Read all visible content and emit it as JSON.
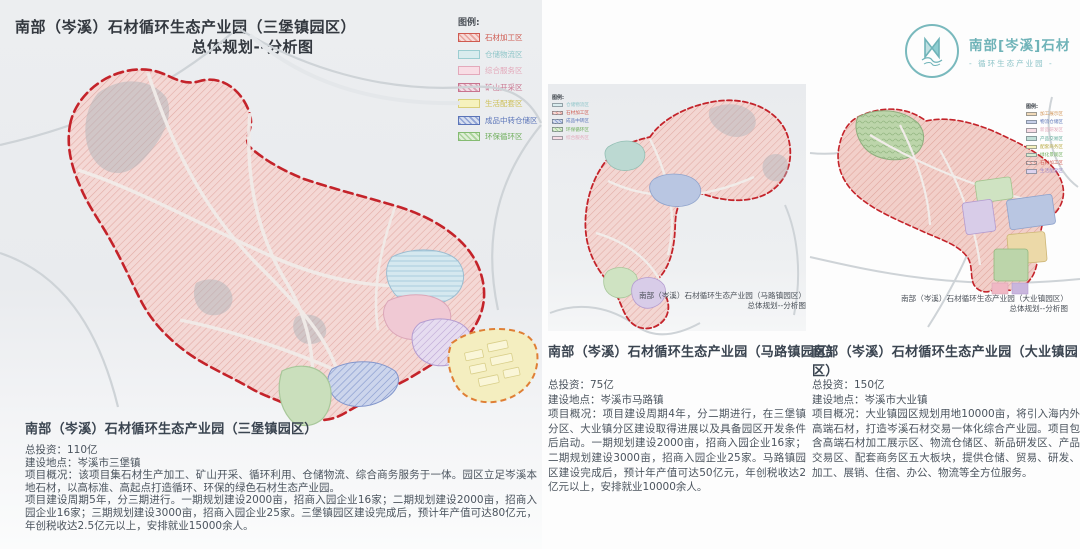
{
  "palette": {
    "boundary_red": "#c4232a",
    "boundary_orange": "#df7f35",
    "parcel_pink": "#f4d8d5",
    "map_background": "#e9ebee",
    "logo_teal": "#6fb3b8",
    "title_color": "#33383f",
    "body_color": "#4b545e"
  },
  "left_panel": {
    "title_line1": "南部（岑溪）石材循环生态产业园（三堡镇园区）",
    "title_line2": "总体规划--分析图",
    "legend": {
      "heading": "图例:",
      "items": [
        {
          "label": "石材加工区",
          "color": "#cf5a50"
        },
        {
          "label": "仓储物流区",
          "color": "#8fc6c9"
        },
        {
          "label": "综合服务区",
          "color": "#e3a9bb"
        },
        {
          "label": "矿山开采区",
          "color": "#c9738e"
        },
        {
          "label": "生活配套区",
          "color": "#cdbf55"
        },
        {
          "label": "成品中转仓储区",
          "color": "#5a74b8"
        },
        {
          "label": "环保循环区",
          "color": "#6fae5c"
        }
      ]
    },
    "section_title": "南部（岑溪）石材循环生态产业园（三堡镇园区）",
    "info_lines": [
      "总投资：110亿",
      "建设地点：岑溪市三堡镇",
      "项目概况：该项目集石材生产加工、矿山开采、循环利用、仓储物流、综合商务服务于一体。园区立足岑溪本地石材，以高标准、高起点打造循环、环保的绿色石材生态产业园。",
      "项目建设周期5年，分三期进行。一期规划建设2000亩，招商入园企业16家；二期规划建设2000亩，招商入园企业16家；三期规划建设3000亩，招商入园企业25家。三堡镇园区建设完成后，预计年产值可达80亿元，年创税收达2.5亿元以上，安排就业15000余人。"
    ]
  },
  "middle_panel": {
    "legend_heading": "图例:",
    "legend_items": [
      {
        "label": "仓储物流区",
        "color": "#8fc6c9"
      },
      {
        "label": "石材加工区",
        "color": "#cf5a50"
      },
      {
        "label": "成品中转区",
        "color": "#5a74b8"
      },
      {
        "label": "环保循环区",
        "color": "#6fae5c"
      },
      {
        "label": "综合服务区",
        "color": "#e3a9bb"
      }
    ],
    "map_caption_line1": "南部（岑溪）石材循环生态产业园（马路镇园区）",
    "map_caption_line2": "总体规划--分析图",
    "section_title": "南部（岑溪）石材循环生态产业园（马路镇园区）",
    "info_lines": [
      "总投资：75亿",
      "建设地点：岑溪市马路镇",
      "项目概况：项目建设周期4年，分二期进行，在三堡镇分区、大业镇分区建设取得进展以及具备园区开发条件后启动。一期规划建设2000亩，招商入园企业16家；二期规划建设3000亩，招商入园企业25家。马路镇园区建设完成后，预计年产值可达50亿元，年创税收达2亿元以上，安排就业10000余人。"
    ]
  },
  "right_panel": {
    "logo": {
      "name_line": "南部[岑溪]石材",
      "sub_line": "- 循环生态产业园 -"
    },
    "legend_heading": "图例:",
    "legend_items": [
      {
        "label": "加工展示区",
        "color": "#cf9353"
      },
      {
        "label": "物流仓储区",
        "color": "#5a74b8"
      },
      {
        "label": "新品研发区",
        "color": "#e3a9bb"
      },
      {
        "label": "产品交易区",
        "color": "#5aa796"
      },
      {
        "label": "配套商务区",
        "color": "#cdbf55"
      },
      {
        "label": "绿化景观区",
        "color": "#6fae5c"
      },
      {
        "label": "石材加工区",
        "color": "#cf5a50"
      },
      {
        "label": "生活配套区",
        "color": "#9a86c9"
      }
    ],
    "map_caption_line1": "南部（岑溪）石材循环生态产业园（大业镇园区）",
    "map_caption_line2": "总体规划--分析图",
    "section_title": "南部（岑溪）石材循环生态产业园（大业镇园区）",
    "info_lines": [
      "总投资：150亿",
      "建设地点：岑溪市大业镇",
      "项目概况：大业镇园区规划用地10000亩，将引入海内外高端石材，打造岑溪石材交易一体化综合产业园。项目包含高端石材加工展示区、物流仓储区、新品研发区、产品交易区、配套商务区五大板块，提供仓储、贸易、研发、加工、展销、住宿、办公、物流等全方位服务。"
    ]
  }
}
